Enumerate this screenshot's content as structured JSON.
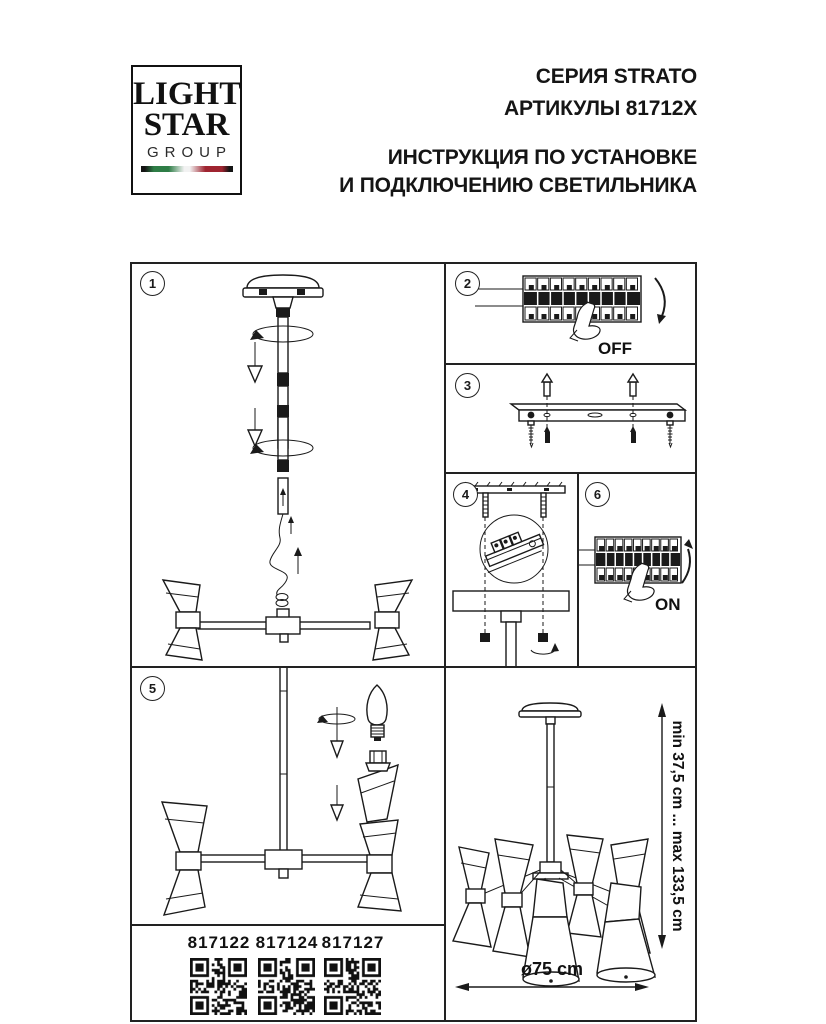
{
  "header": {
    "logo": {
      "line1": "LIGHT",
      "line2": "STAR",
      "line3": "GROUP"
    },
    "series": "СЕРИЯ STRATO",
    "articles_line": "АРТИКУЛЫ 81712X",
    "instruction_line1": "ИНСТРУКЦИЯ ПО УСТАНОВКЕ",
    "instruction_line2": "И ПОДКЛЮЧЕНИЮ СВЕТИЛЬНИКА"
  },
  "steps": [
    "1",
    "2",
    "3",
    "4",
    "5",
    "6"
  ],
  "labels": {
    "breaker_off": "OFF",
    "breaker_on": "ON"
  },
  "dimensions": {
    "height_range": "min 37,5 cm ... max 133,5 cm",
    "diameter": "ø75 cm"
  },
  "articles": [
    "817122",
    "817124",
    "817127"
  ],
  "colors": {
    "line": "#1a1a1a",
    "flag_green": "#2e7d46",
    "flag_red": "#9f2430",
    "flag_dark": "#141414"
  }
}
